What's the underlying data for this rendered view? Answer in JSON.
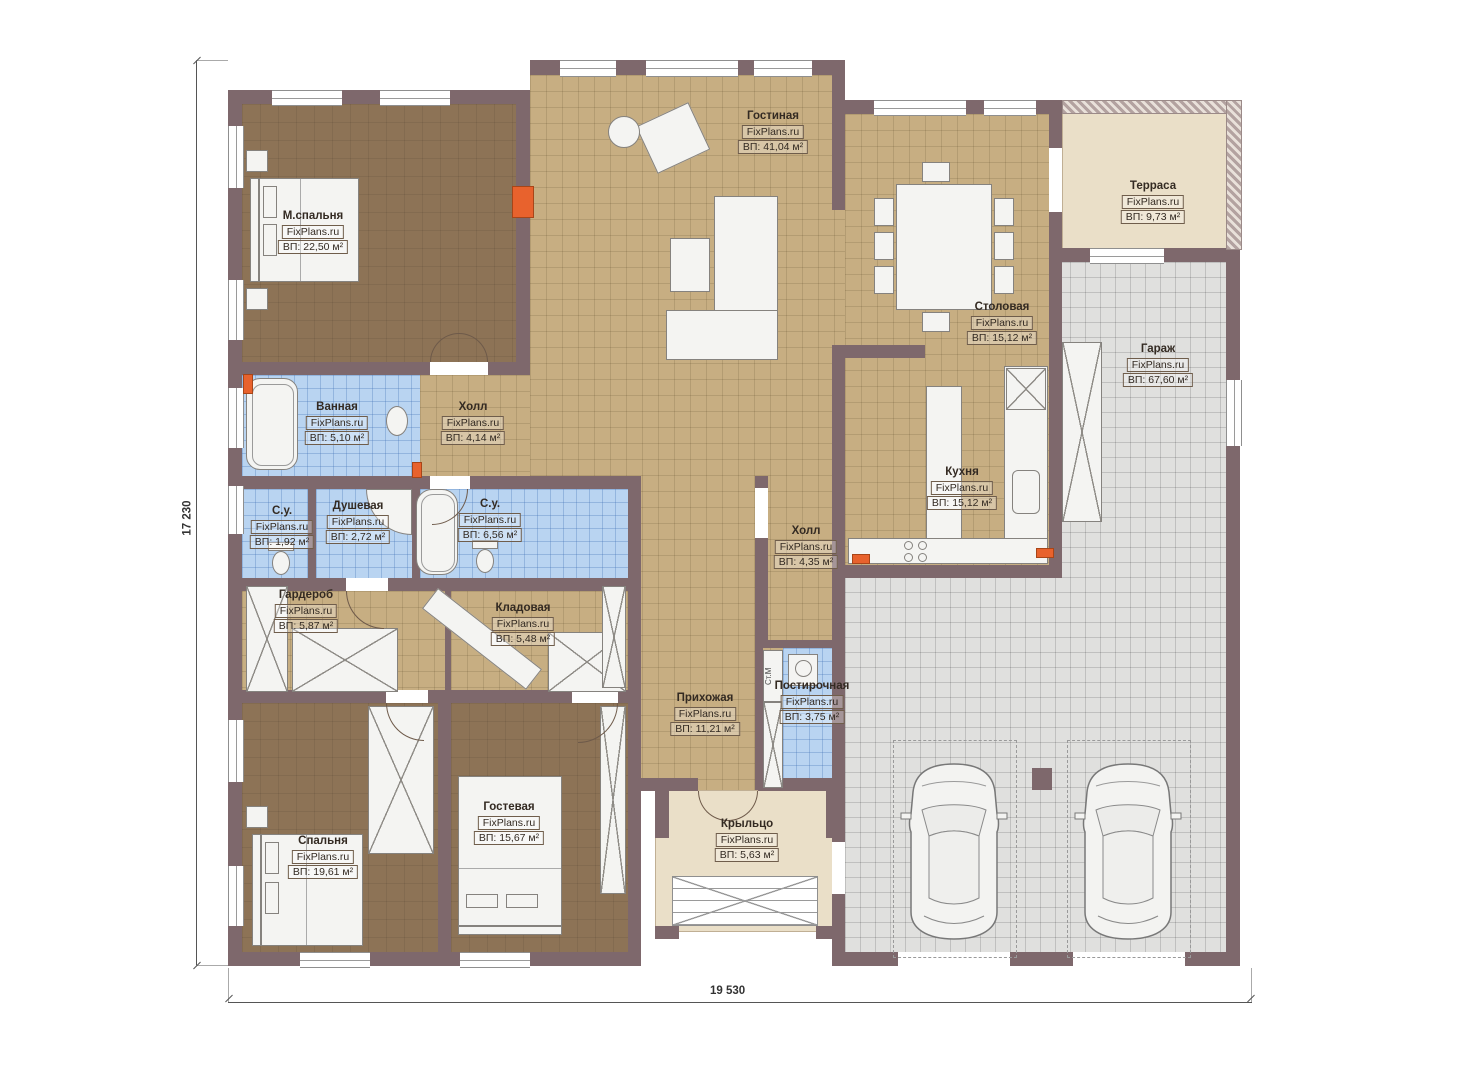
{
  "brand": "FixPlans.ru",
  "rooms": [
    {
      "name": "Гостиная",
      "area": "ВП: 41,04 м²"
    },
    {
      "name": "М.спальня",
      "area": "ВП: 22,50 м²"
    },
    {
      "name": "Терраса",
      "area": "ВП: 9,73 м²"
    },
    {
      "name": "Столовая",
      "area": "ВП: 15,12 м²"
    },
    {
      "name": "Гараж",
      "area": "ВП: 67,60 м²"
    },
    {
      "name": "Ванная",
      "area": "ВП: 5,10 м²"
    },
    {
      "name": "Холл",
      "area": "ВП: 4,14 м²"
    },
    {
      "name": "С.у.",
      "area": "ВП: 1,92 м²"
    },
    {
      "name": "Душевая",
      "area": "ВП: 2,72 м²"
    },
    {
      "name": "С.у.",
      "area": "ВП: 6,56 м²"
    },
    {
      "name": "Кухня",
      "area": "ВП: 15,12 м²"
    },
    {
      "name": "Холл",
      "area": "ВП: 4,35 м²"
    },
    {
      "name": "Гардероб",
      "area": "ВП: 5,87 м²"
    },
    {
      "name": "Кладовая",
      "area": "ВП: 5,48 м²"
    },
    {
      "name": "Прихожая",
      "area": "ВП: 11,21 м²"
    },
    {
      "name": "Постирочная",
      "area": "ВП: 3,75 м²"
    },
    {
      "name": "Гостевая",
      "area": "ВП: 15,67 м²"
    },
    {
      "name": "Спальня",
      "area": "ВП: 19,61 м²"
    },
    {
      "name": "Крыльцо",
      "area": "ВП: 5,63 м²"
    }
  ],
  "dimensions": {
    "bottom": "19 530",
    "left": "17 230"
  },
  "annotations": {
    "washing_machine": "Ст.М"
  },
  "colors": {
    "wall": "#7e686c",
    "floor_wood": "#8d7356",
    "floor_tile": "#c7ae82",
    "floor_bath": "#b9d4f1",
    "floor_garage": "#e0e0de",
    "terrace": "#eadfc8",
    "radiator": "#e8622d"
  }
}
